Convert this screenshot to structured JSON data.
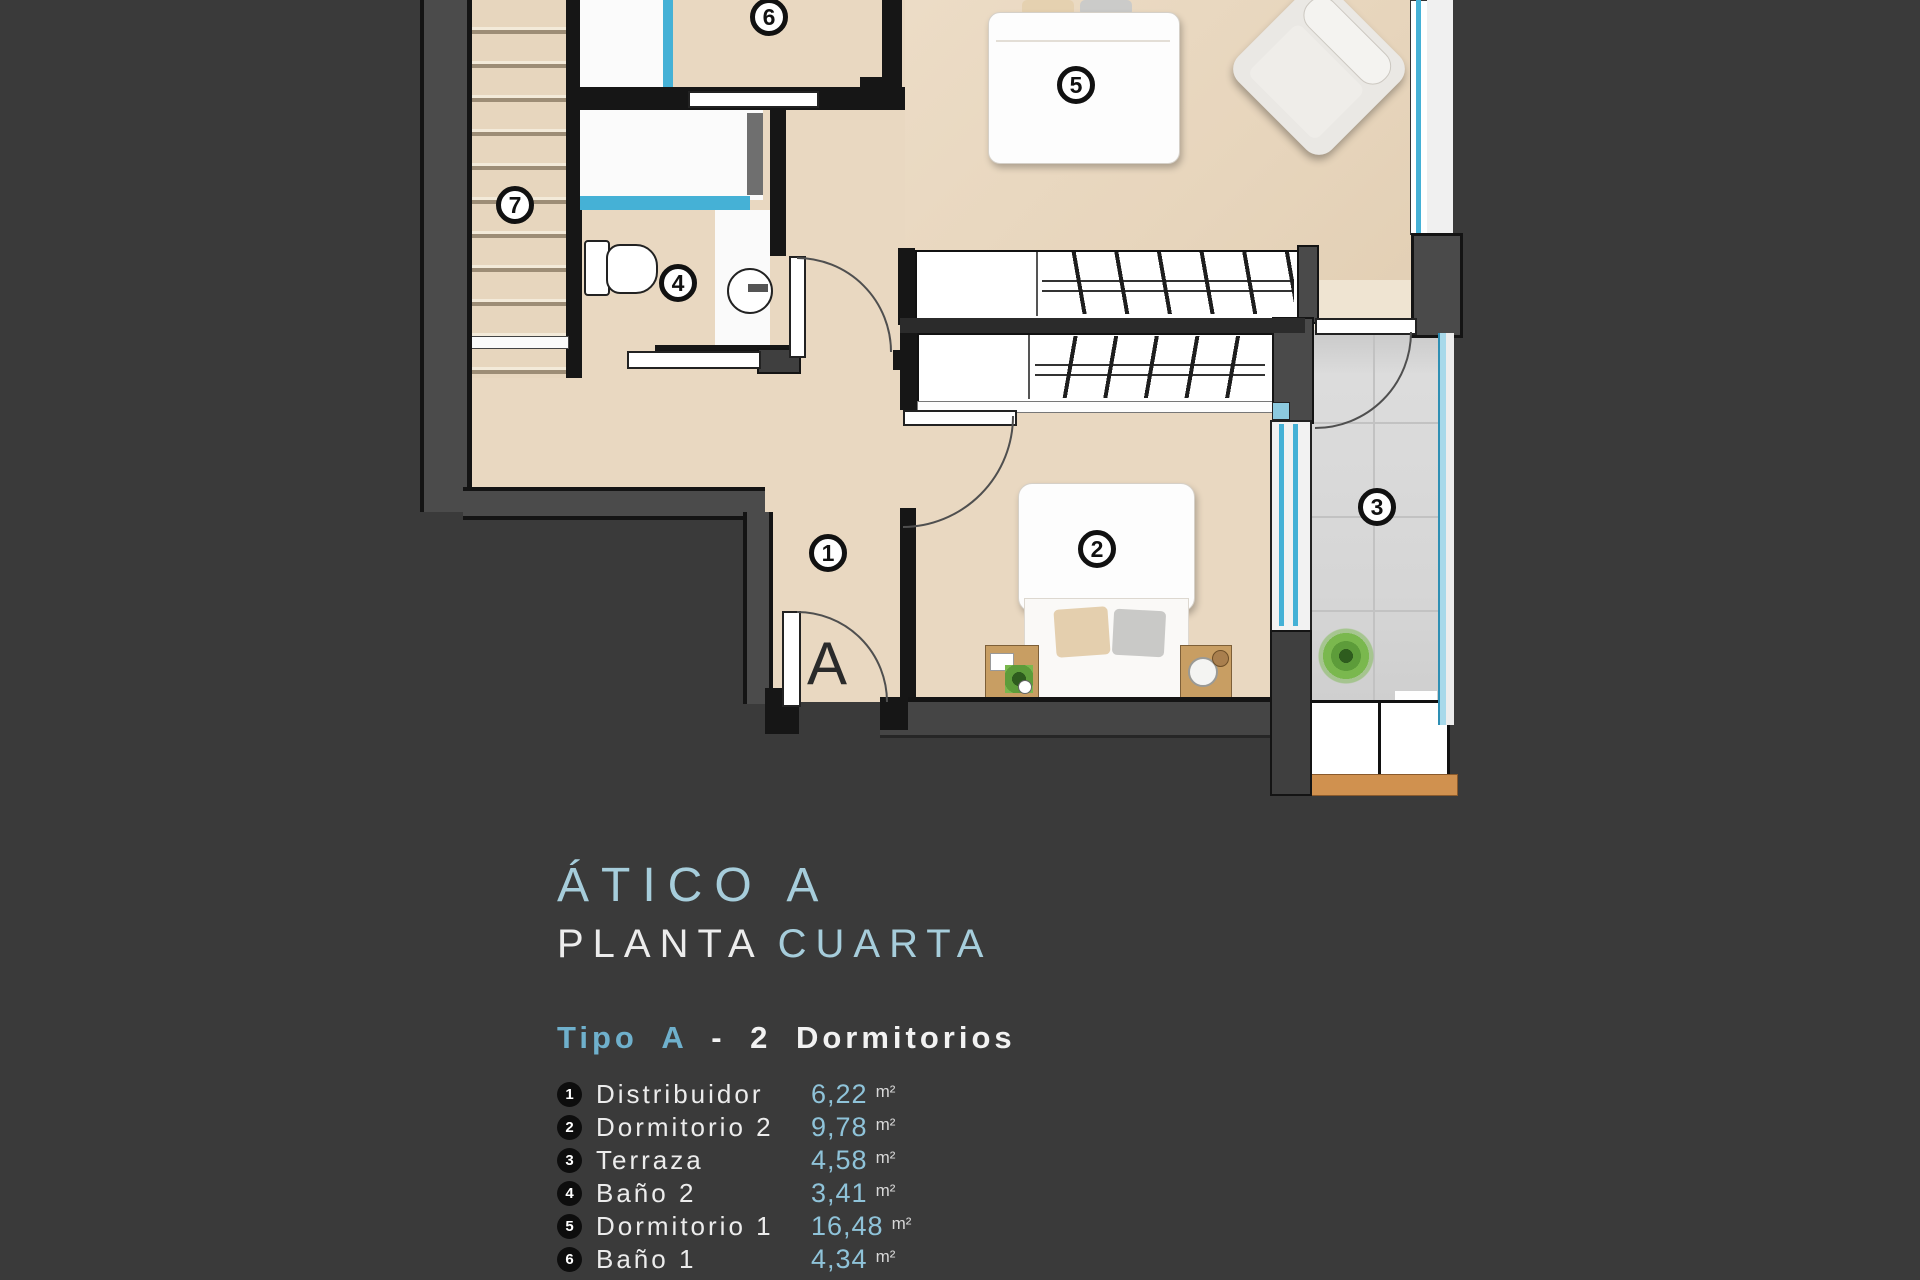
{
  "title": {
    "line1": "ÁTICO A",
    "line2_white": "PLANTA",
    "line2_blue": "CUARTA"
  },
  "subtitle": {
    "part1": "Tipo A",
    "part2": "- 2 Dormitorios"
  },
  "legend": {
    "items": [
      {
        "num": "1",
        "label": "Distribuidor",
        "area": "6,22",
        "unit": "m²"
      },
      {
        "num": "2",
        "label": "Dormitorio 2",
        "area": "9,78",
        "unit": "m²"
      },
      {
        "num": "3",
        "label": "Terraza",
        "area": "4,58",
        "unit": "m²"
      },
      {
        "num": "4",
        "label": "Baño 2",
        "area": "3,41",
        "unit": "m²"
      },
      {
        "num": "5",
        "label": "Dormitorio 1",
        "area": "16,48",
        "unit": "m²"
      },
      {
        "num": "6",
        "label": "Baño 1",
        "area": "4,34",
        "unit": "m²"
      },
      {
        "num": "7",
        "label": "Escalera",
        "area": "3,75",
        "unit": "m²"
      }
    ]
  },
  "plan": {
    "badges": [
      {
        "label": "1"
      },
      {
        "label": "2"
      },
      {
        "label": "3"
      },
      {
        "label": "4"
      },
      {
        "label": "5"
      },
      {
        "label": "6"
      },
      {
        "label": "7"
      }
    ],
    "entrance_label": "A"
  },
  "colors": {
    "background": "#3a3a3a",
    "floor_beige": "#e9d8c1",
    "terrace_gray": "#d6d6d6",
    "glass_blue": "#45b1d6",
    "title_blue": "#a6cddb",
    "accent_blue": "#6fb0cc",
    "value_blue": "#8fc3d9",
    "wood": "#d0914f"
  }
}
